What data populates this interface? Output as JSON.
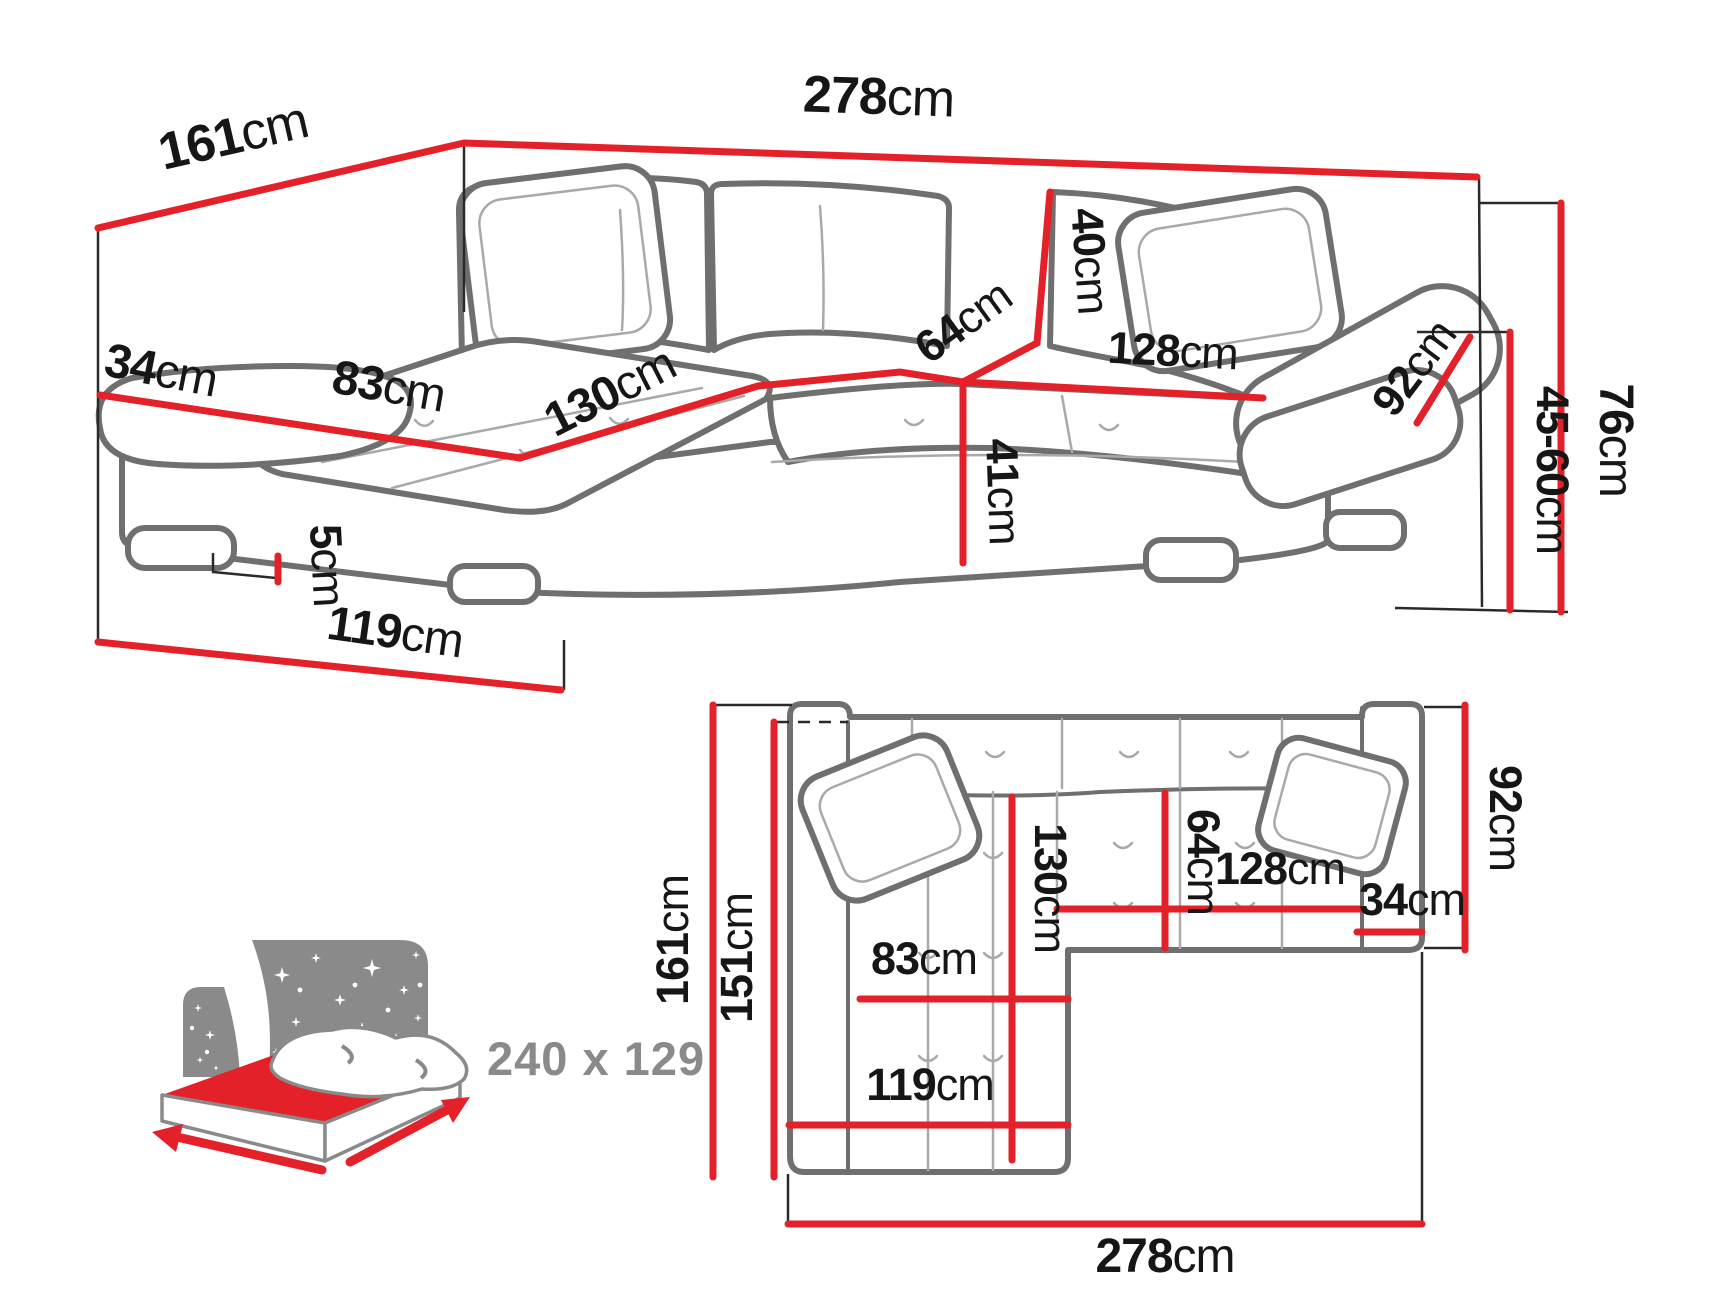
{
  "colors": {
    "dimension_red": "#e42028",
    "outline_gray": "#6f6f6f",
    "detail_gray": "#a9a9a9",
    "extension_black": "#2a2a2a",
    "label_black": "#161616",
    "icon_gray": "#8a8a8a",
    "background": "#ffffff"
  },
  "perspective_view": {
    "dims": {
      "total_depth": {
        "value": "161",
        "unit": "cm"
      },
      "total_width": {
        "value": "278",
        "unit": "cm"
      },
      "armrest_width": {
        "value": "34",
        "unit": "cm"
      },
      "chaise_seat_width": {
        "value": "83",
        "unit": "cm"
      },
      "chaise_seat_depth": {
        "value": "130",
        "unit": "cm"
      },
      "backrest_height": {
        "value": "40",
        "unit": "cm"
      },
      "seat_depth": {
        "value": "64",
        "unit": "cm"
      },
      "seat_width": {
        "value": "128",
        "unit": "cm"
      },
      "seat_height": {
        "value": "41",
        "unit": "cm"
      },
      "armrest_depth": {
        "value": "92",
        "unit": "cm"
      },
      "total_height": {
        "value": "76",
        "unit": "cm"
      },
      "armrest_height": {
        "value": "45-60",
        "unit": "cm"
      },
      "leg_height": {
        "value": "5",
        "unit": "cm"
      },
      "chaise_length": {
        "value": "119",
        "unit": "cm"
      }
    }
  },
  "plan_view": {
    "dims": {
      "total_depth": {
        "value": "161",
        "unit": "cm"
      },
      "inner_depth": {
        "value": "151",
        "unit": "cm"
      },
      "chaise_seat_depth": {
        "value": "130",
        "unit": "cm"
      },
      "seat_depth": {
        "value": "64",
        "unit": "cm"
      },
      "seat_width": {
        "value": "128",
        "unit": "cm"
      },
      "armrest_width": {
        "value": "34",
        "unit": "cm"
      },
      "armrest_depth": {
        "value": "92",
        "unit": "cm"
      },
      "chaise_seat_width": {
        "value": "83",
        "unit": "cm"
      },
      "chaise_length": {
        "value": "119",
        "unit": "cm"
      },
      "total_width": {
        "value": "278",
        "unit": "cm"
      }
    }
  },
  "sleeping_icon": {
    "sleeping_area": {
      "value": "240 x 129",
      "unit": ""
    }
  }
}
